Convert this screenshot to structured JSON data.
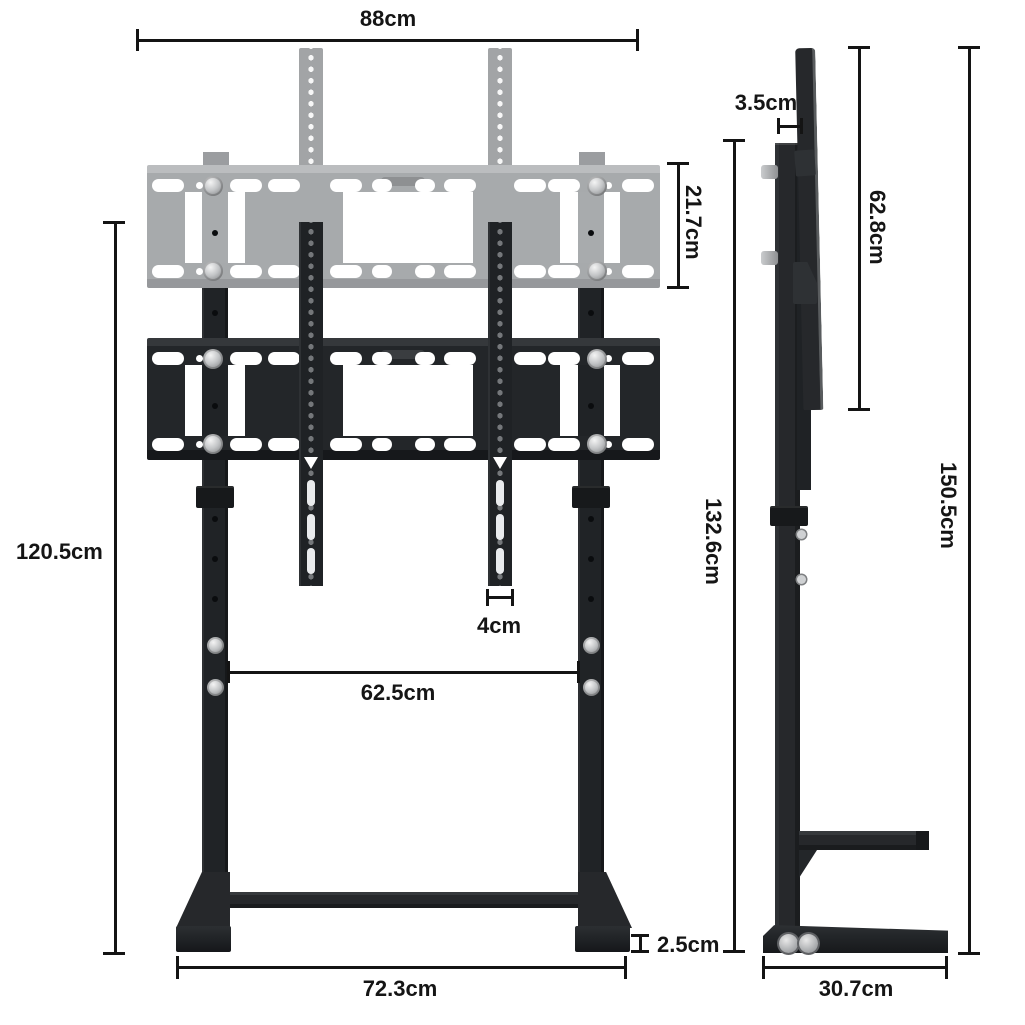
{
  "title": "TV floor stand dimension diagram",
  "labels": {
    "front": {
      "width": "88cm",
      "bracket_height": "21.7cm",
      "stand_height": "120.5cm",
      "rail_width": "4cm",
      "leg_spacing": "62.5cm",
      "foot_height": "2.5cm",
      "base_width": "72.3cm"
    },
    "side": {
      "depth_top": "3.5cm",
      "plate_height": "62.8cm",
      "frame_height": "132.6cm",
      "total_height": "150.5cm",
      "base_depth": "30.7cm"
    }
  },
  "colors": {
    "background": "#ffffff",
    "steel_black": "#26282b",
    "ghost_gray": "#a8abad",
    "dimension_line": "#141414",
    "label_text": "#151515"
  }
}
